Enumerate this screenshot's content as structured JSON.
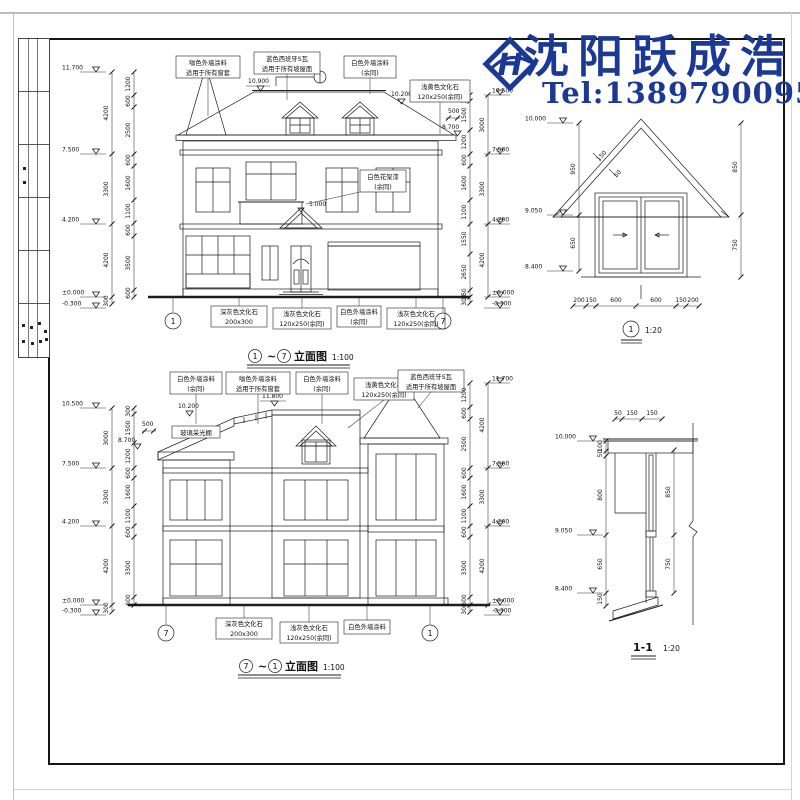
{
  "watermark": {
    "brand": "沈阳跃成浩",
    "tel": "Tel:13897900953",
    "logo_letter": "H",
    "color": "#1b3894"
  },
  "elev1": {
    "title": {
      "num_l": "1",
      "tilde": "~",
      "num_r": "7",
      "label": "立面图",
      "scale": "1:100"
    },
    "grid_left": "1",
    "grid_right": "7",
    "notes_top": [
      {
        "l1": "咖色外墙涂料",
        "l2": "适用于所有窗套"
      },
      {
        "l1": "蓝色西班牙S瓦",
        "l2": "适用于所有坡屋面"
      },
      {
        "l1": "白色外墙涂料",
        "l2": "(余同)"
      },
      {
        "l1": "浅黄色文化石",
        "l2": "120x250(余同)"
      }
    ],
    "note_flower": {
      "l1": "白色花架漆",
      "l2": "(余同)"
    },
    "notes_bottom": [
      {
        "l1": "深灰色文化石",
        "l2": "200x300"
      },
      {
        "l1": "浅灰色文化石",
        "l2": "120x250(余同)"
      },
      {
        "l1": "白色外墙涂料",
        "l2": "(余同)"
      },
      {
        "l1": "浅灰色文化石",
        "l2": "120x250(余同)"
      }
    ],
    "marks": {
      "ridge": "10.900",
      "right_slope": "10.200",
      "eave": "8.700",
      "eave_dim": "500",
      "entry": "5.000"
    },
    "levels_left": [
      "11.700",
      "7.500",
      "4.200",
      "±0.000",
      "-0.300"
    ],
    "levels_right": [
      "10.500",
      "7.500",
      "4.200",
      "±0.000",
      "-0.300"
    ],
    "dims_left_outer": [
      "4200",
      "3300",
      "4200",
      "300"
    ],
    "dims_left_inner": [
      "1200",
      "600",
      "2500",
      "600",
      "1600",
      "1100",
      "600",
      "3500",
      "600"
    ],
    "dims_right_inner": [
      "300",
      "1500",
      "1200",
      "600",
      "1600",
      "1100",
      "1550",
      "2650",
      "150",
      "300"
    ],
    "dims_right_outer": [
      "3000",
      "3300",
      "4200"
    ]
  },
  "detail1": {
    "title_num": "1",
    "scale": "1:20",
    "levels": [
      "10.000",
      "9.050",
      "8.400"
    ],
    "dims_left": [
      "950",
      "650"
    ],
    "dims_right": [
      "850",
      "750"
    ],
    "dims_slope": [
      "150",
      "50"
    ],
    "dims_bottom": [
      "200",
      "150",
      "600",
      "600",
      "150",
      "200"
    ]
  },
  "elev2": {
    "title": {
      "num_l": "7",
      "tilde": "~",
      "num_r": "1",
      "label": "立面图",
      "scale": "1:100"
    },
    "grid_left": "7",
    "grid_right": "1",
    "notes_top": [
      {
        "l1": "白色外墙涂料",
        "l2": "(余同)"
      },
      {
        "l1": "咖色外墙涂料",
        "l2": "适用于所有窗套"
      },
      {
        "l1": "白色外墙涂料",
        "l2": "(余同)"
      },
      {
        "l1": "浅黄色文化石",
        "l2": "120x250(余同)"
      },
      {
        "l1": "蓝色西班牙S瓦",
        "l2": "适用于所有坡屋面"
      }
    ],
    "label_skylight": "玻璃采光棚",
    "marks": {
      "flat": "11.800",
      "slope": "10.200",
      "eave": "8.700",
      "eave_dim": "500"
    },
    "notes_bottom": [
      {
        "l1": "深灰色文化石",
        "l2": "200x300"
      },
      {
        "l1": "浅灰色文化石",
        "l2": "120x250(余同)"
      },
      {
        "l1": "白色外墙涂料",
        "l2": ""
      }
    ],
    "levels_left": [
      "10.500",
      "7.500",
      "4.200",
      "±0.000",
      "-0.300"
    ],
    "levels_right": [
      "11.700",
      "7.500",
      "4.200",
      "±0.000",
      "-0.300"
    ],
    "dims_left_outer": [
      "3000",
      "3300",
      "4200",
      "300"
    ],
    "dims_left_inner": [
      "300",
      "1500",
      "1200",
      "600",
      "1600",
      "1100",
      "600",
      "3300",
      "600"
    ],
    "dims_right_inner": [
      "1200",
      "600",
      "2500",
      "600",
      "1600",
      "1100",
      "600",
      "3300",
      "600",
      "300"
    ],
    "dims_right_outer": [
      "4200",
      "3300",
      "4200"
    ]
  },
  "section11": {
    "title": "1-1",
    "scale": "1:20",
    "levels": [
      "10.000",
      "9.050",
      "8.400"
    ],
    "dims_top": [
      "50",
      "150",
      "150"
    ],
    "dims_left": [
      "100",
      "50",
      "800",
      "650",
      "150"
    ],
    "dims_right": [
      "850",
      "750"
    ]
  }
}
